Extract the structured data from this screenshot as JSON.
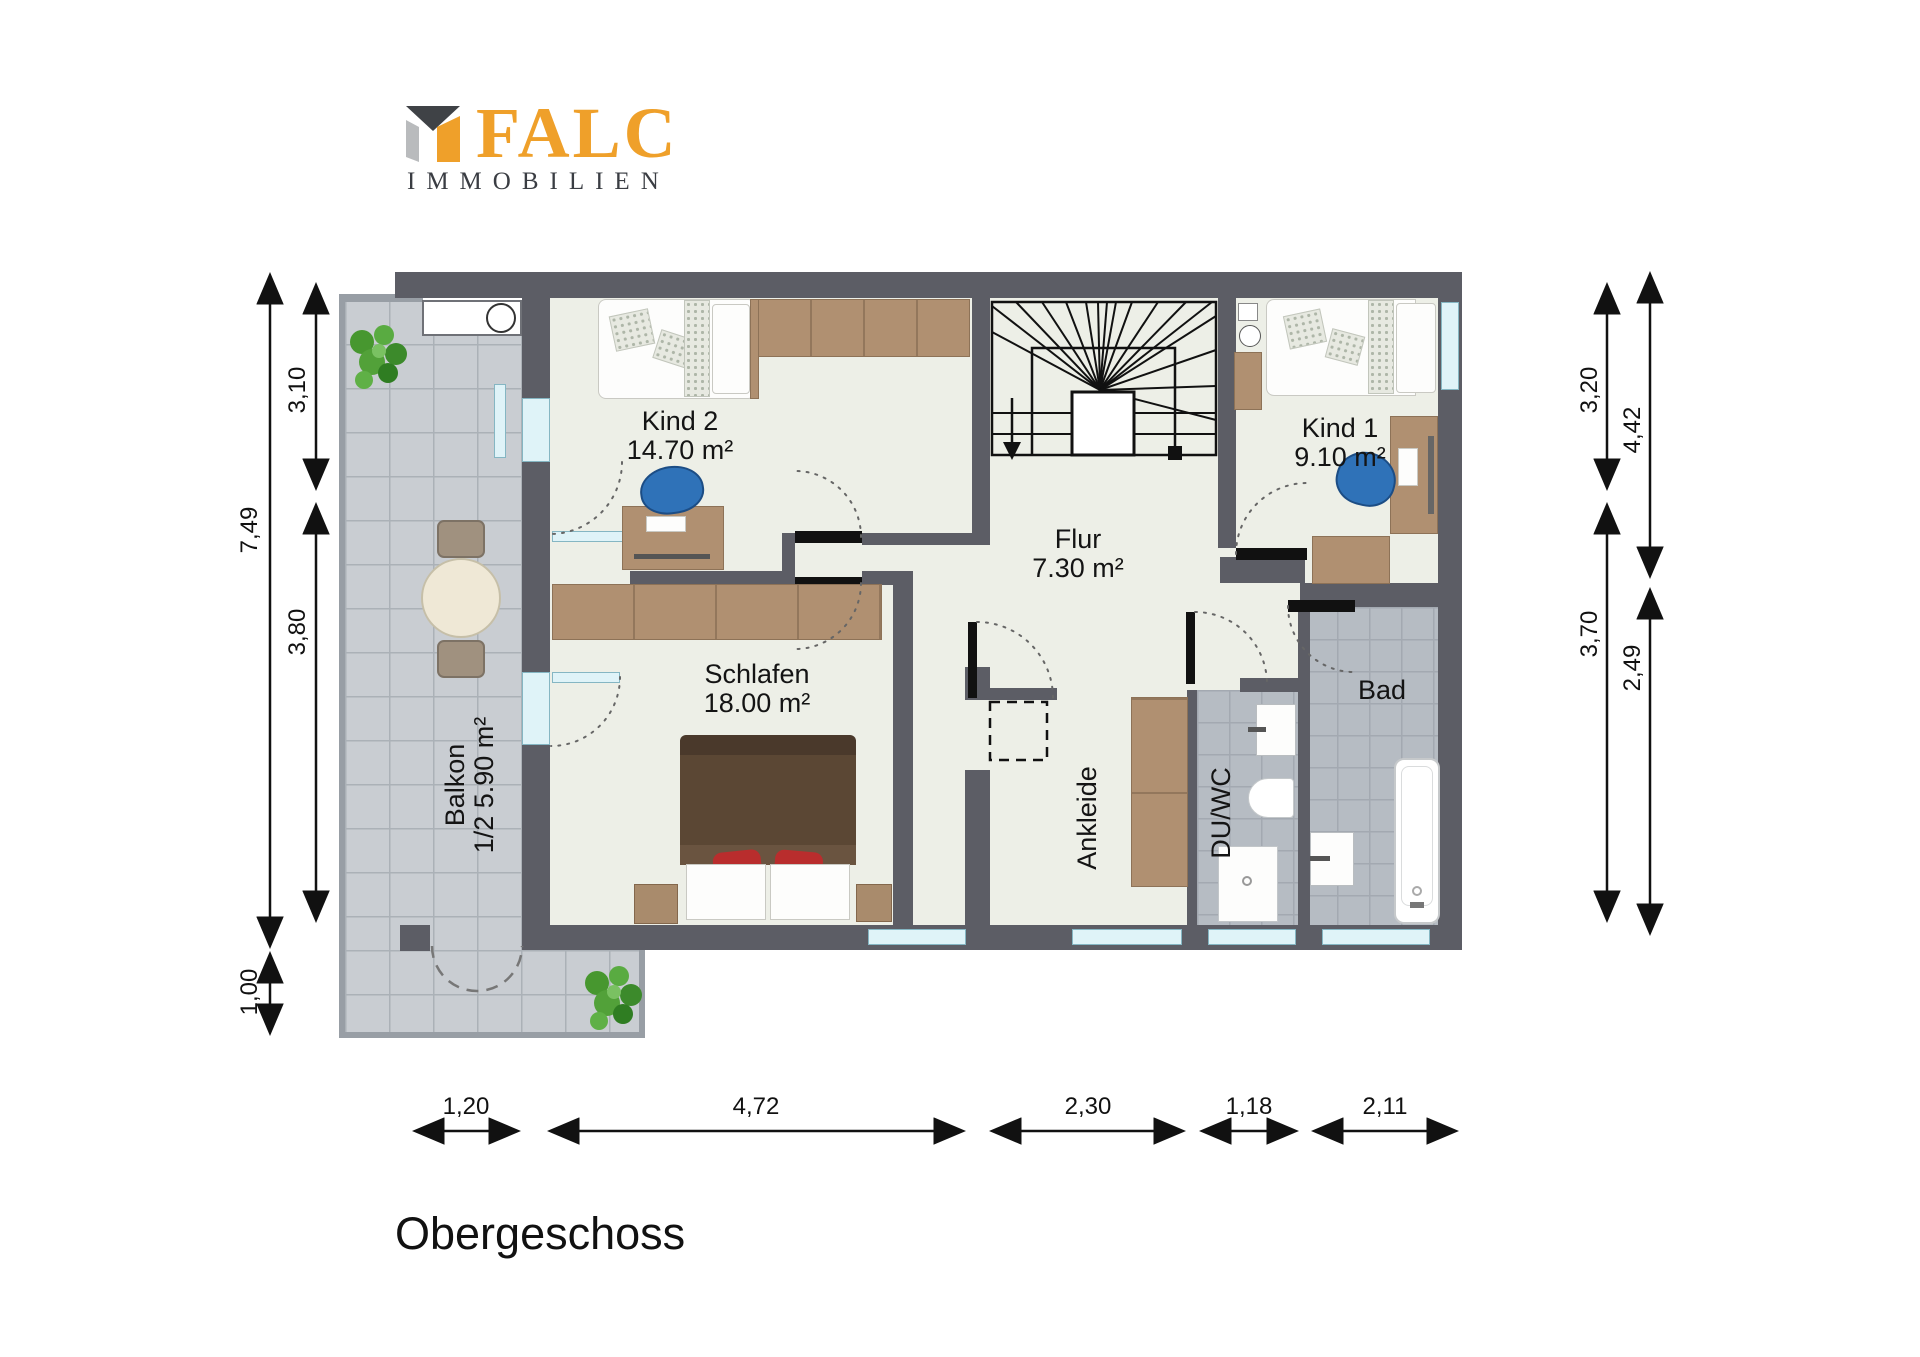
{
  "logo": {
    "brand": "FALC",
    "subtitle": "IMMOBILIEN"
  },
  "title": "Obergeschoss",
  "rooms": {
    "kind2": {
      "name": "Kind 2",
      "area": "14.70 m²"
    },
    "kind1": {
      "name": "Kind 1",
      "area": "9.10 m²"
    },
    "flur": {
      "name": "Flur",
      "area": "7.30 m²"
    },
    "schlafen": {
      "name": "Schlafen",
      "area": "18.00 m²"
    },
    "balkon": {
      "name": "Balkon",
      "area": "1/2 5.90 m²"
    },
    "ankleide": {
      "name": "Ankleide"
    },
    "duwc": {
      "name": "DU/WC"
    },
    "bad": {
      "name": "Bad"
    }
  },
  "dimensions": {
    "left_total": "7,49",
    "left_upper": "3,10",
    "left_lower": "3,80",
    "left_balcony": "1,00",
    "right_inner_upper": "3,20",
    "right_inner_lower": "3,70",
    "right_outer_upper": "4,42",
    "right_outer_lower": "2,49",
    "bottom": [
      "1,20",
      "4,72",
      "2,30",
      "1,18",
      "2,11"
    ]
  },
  "colors": {
    "wall": "#5c5d65",
    "floor": "#edefe7",
    "balcony_tile": "#c9cdd2",
    "bath_tile": "#b6bcc3",
    "brand_orange": "#efa02a",
    "wood": "#b09071",
    "window": "#dff3f8"
  }
}
